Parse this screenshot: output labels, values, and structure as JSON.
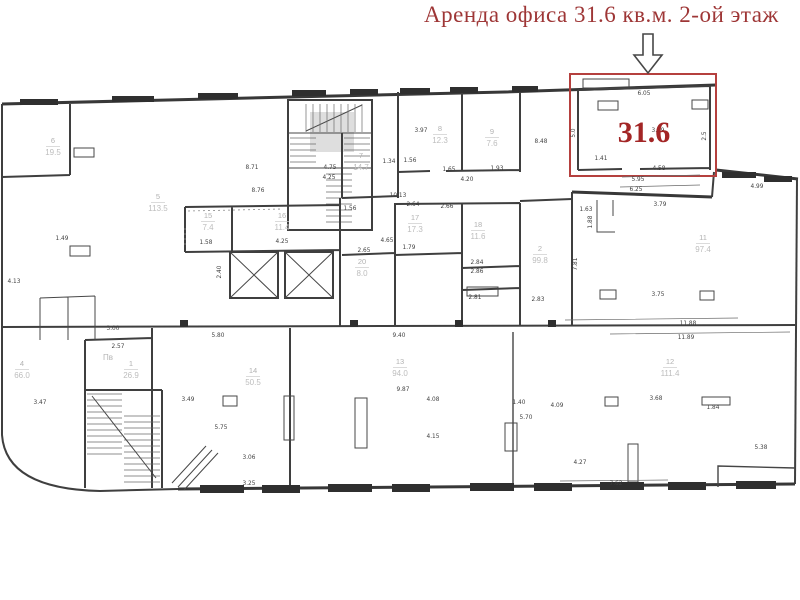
{
  "title": {
    "text": "Аренда офиса 31.6 кв.м. 2-ой этаж",
    "color": "#9e3636"
  },
  "highlight": {
    "area_value": "31.6",
    "x": 644,
    "y": 142,
    "border_color": "#b5403e",
    "label_color": "#a32626"
  },
  "rooms": [
    {
      "n": "6",
      "a": "19.5",
      "x": 53,
      "y": 143
    },
    {
      "n": "5",
      "a": "113.5",
      "x": 158,
      "y": 199
    },
    {
      "n": "7",
      "a": "14.7",
      "x": 361,
      "y": 158
    },
    {
      "n": "8",
      "a": "12.3",
      "x": 440,
      "y": 131
    },
    {
      "n": "9",
      "a": "7.6",
      "x": 492,
      "y": 134
    },
    {
      "n": "15",
      "a": "7.4",
      "x": 208,
      "y": 218
    },
    {
      "n": "16",
      "a": "11.4",
      "x": 282,
      "y": 218
    },
    {
      "n": "17",
      "a": "17.3",
      "x": 415,
      "y": 220
    },
    {
      "n": "18",
      "a": "11.6",
      "x": 478,
      "y": 227
    },
    {
      "n": "20",
      "a": "8.0",
      "x": 362,
      "y": 264
    },
    {
      "n": "2",
      "a": "99.8",
      "x": 540,
      "y": 251
    },
    {
      "n": "11",
      "a": "97.4",
      "x": 703,
      "y": 240
    },
    {
      "n": "4",
      "a": "66.0",
      "x": 22,
      "y": 366
    },
    {
      "n": "1",
      "a": "26.9",
      "x": 131,
      "y": 366
    },
    {
      "n": "14",
      "a": "50.5",
      "x": 253,
      "y": 373
    },
    {
      "n": "13",
      "a": "94.0",
      "x": 400,
      "y": 364
    },
    {
      "n": "12",
      "a": "111.4",
      "x": 670,
      "y": 364
    }
  ],
  "extra_labels": [
    {
      "t": "Пв",
      "x": 108,
      "y": 360
    }
  ],
  "dimensions": [
    {
      "t": "6.05",
      "x": 644,
      "y": 95
    },
    {
      "t": "3.49",
      "x": 658,
      "y": 132
    },
    {
      "t": "1.41",
      "x": 601,
      "y": 160
    },
    {
      "t": "4.58",
      "x": 659,
      "y": 170
    },
    {
      "t": "5.95",
      "x": 638,
      "y": 181
    },
    {
      "t": "6.25",
      "x": 636,
      "y": 191
    },
    {
      "t": "5.0",
      "x": 575,
      "y": 133,
      "r": -90
    },
    {
      "t": "2.5",
      "x": 706,
      "y": 136,
      "r": -90
    },
    {
      "t": "4.99",
      "x": 757,
      "y": 188
    },
    {
      "t": "3.79",
      "x": 660,
      "y": 206
    },
    {
      "t": "1.63",
      "x": 586,
      "y": 211
    },
    {
      "t": "1.88",
      "x": 592,
      "y": 222,
      "r": -90
    },
    {
      "t": "7.81",
      "x": 577,
      "y": 264,
      "r": -90
    },
    {
      "t": "3.75",
      "x": 658,
      "y": 296
    },
    {
      "t": "11.88",
      "x": 688,
      "y": 325
    },
    {
      "t": "11.89",
      "x": 686,
      "y": 339
    },
    {
      "t": "3.68",
      "x": 656,
      "y": 400
    },
    {
      "t": "1.84",
      "x": 713,
      "y": 409
    },
    {
      "t": "5.38",
      "x": 761,
      "y": 449
    },
    {
      "t": "4.27",
      "x": 580,
      "y": 464
    },
    {
      "t": "7.62",
      "x": 616,
      "y": 485
    },
    {
      "t": "4.08",
      "x": 433,
      "y": 401
    },
    {
      "t": "4.09",
      "x": 557,
      "y": 407
    },
    {
      "t": "4.15",
      "x": 433,
      "y": 438
    },
    {
      "t": "5.70",
      "x": 526,
      "y": 419
    },
    {
      "t": "1.40",
      "x": 519,
      "y": 404
    },
    {
      "t": "5.80",
      "x": 218,
      "y": 337
    },
    {
      "t": "9.40",
      "x": 399,
      "y": 337
    },
    {
      "t": "9.87",
      "x": 403,
      "y": 391
    },
    {
      "t": "5.75",
      "x": 221,
      "y": 429
    },
    {
      "t": "3.06",
      "x": 249,
      "y": 459
    },
    {
      "t": "3.25",
      "x": 249,
      "y": 485
    },
    {
      "t": "3.49",
      "x": 188,
      "y": 401
    },
    {
      "t": "3.47",
      "x": 40,
      "y": 404
    },
    {
      "t": "3.00",
      "x": 113,
      "y": 330
    },
    {
      "t": "2.57",
      "x": 118,
      "y": 348
    },
    {
      "t": "8.71",
      "x": 252,
      "y": 169
    },
    {
      "t": "8.76",
      "x": 258,
      "y": 192
    },
    {
      "t": "4.25",
      "x": 282,
      "y": 243
    },
    {
      "t": "1.58",
      "x": 206,
      "y": 244
    },
    {
      "t": "2.40",
      "x": 221,
      "y": 272,
      "r": -90
    },
    {
      "t": "4.75",
      "x": 330,
      "y": 169
    },
    {
      "t": "4.25",
      "x": 329,
      "y": 179
    },
    {
      "t": "3.97",
      "x": 421,
      "y": 132
    },
    {
      "t": "1.56",
      "x": 410,
      "y": 162
    },
    {
      "t": "1.65",
      "x": 449,
      "y": 171
    },
    {
      "t": "1.93",
      "x": 497,
      "y": 170
    },
    {
      "t": "4.20",
      "x": 467,
      "y": 181
    },
    {
      "t": "8.48",
      "x": 541,
      "y": 143
    },
    {
      "t": "10.13",
      "x": 398,
      "y": 197
    },
    {
      "t": "2.66",
      "x": 447,
      "y": 208
    },
    {
      "t": "2.64",
      "x": 413,
      "y": 206
    },
    {
      "t": "2.65",
      "x": 364,
      "y": 252
    },
    {
      "t": "4.65",
      "x": 387,
      "y": 242
    },
    {
      "t": "1.79",
      "x": 409,
      "y": 249
    },
    {
      "t": "1.56",
      "x": 350,
      "y": 210
    },
    {
      "t": "2.84",
      "x": 477,
      "y": 264
    },
    {
      "t": "2.86",
      "x": 477,
      "y": 273
    },
    {
      "t": "2.81",
      "x": 475,
      "y": 299
    },
    {
      "t": "2.83",
      "x": 538,
      "y": 301
    },
    {
      "t": "1.49",
      "x": 62,
      "y": 240
    },
    {
      "t": "4.13",
      "x": 14,
      "y": 283
    },
    {
      "t": "1.34",
      "x": 389,
      "y": 163
    }
  ]
}
